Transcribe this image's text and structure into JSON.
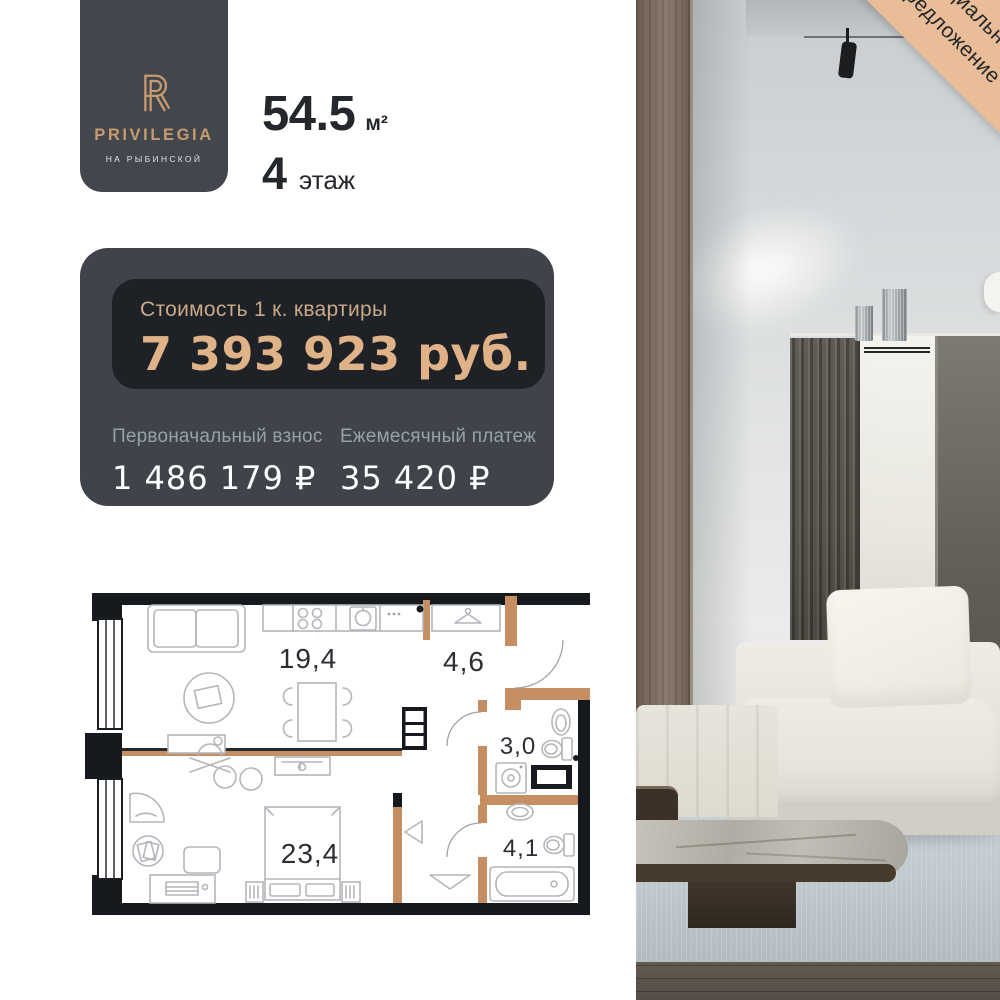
{
  "banner": {
    "line1": "Специальное",
    "line2": "предложение"
  },
  "logo": {
    "brand": "PRIVILEGIA",
    "subtitle": "НА РЫБИНСКОЙ"
  },
  "apartment": {
    "area_value": "54.5",
    "area_unit": "м²",
    "floor_value": "4",
    "floor_label": "этаж"
  },
  "price_card": {
    "price_label": "Стоимость 1 к. квартиры",
    "price_value": "7 393 923 руб.",
    "down_label": "Первоначальный взнос",
    "down_value": "1 486 179 ₽",
    "monthly_label": "Ежемесячный платеж",
    "monthly_value": "35 420 ₽"
  },
  "floor_plan": {
    "rooms": [
      {
        "name": "kitchen-living",
        "area": "19,4"
      },
      {
        "name": "hallway",
        "area": "4,6"
      },
      {
        "name": "bathroom",
        "area": "3,0"
      },
      {
        "name": "bedroom",
        "area": "23,4"
      },
      {
        "name": "bathroom-2",
        "area": "4,1"
      }
    ]
  },
  "colors": {
    "brand_gold": "#c89a6d",
    "price_gold": "#e0b287",
    "card_dark": "#3f444b",
    "card_darker": "#1e2126",
    "banner_tan": "#e8bd98",
    "plan_wall": "#16191d",
    "plan_wood": "#c58f63"
  }
}
